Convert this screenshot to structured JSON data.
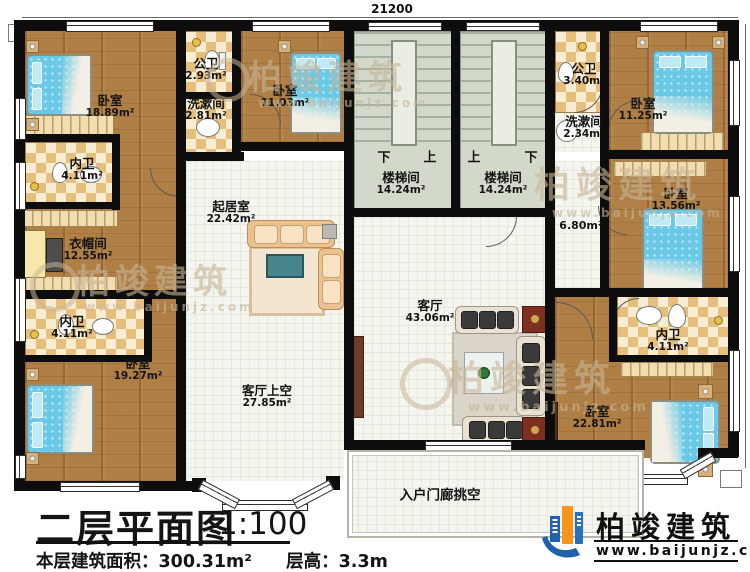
{
  "dimensions": {
    "top": "21200",
    "right": "13800"
  },
  "rooms": {
    "bedroom_tl": {
      "name": "卧室",
      "area": "18.89m²"
    },
    "gongwei_left": {
      "name": "公卫",
      "area": "2.93m²"
    },
    "xishujian_left": {
      "name": "洗漱间",
      "area": "2.81m²"
    },
    "bedroom_tm": {
      "name": "卧室",
      "area": "11.03m²"
    },
    "neiwei_top": {
      "name": "内卫",
      "area": "4.11m²"
    },
    "cloakroom": {
      "name": "衣帽间",
      "area": "12.55m²"
    },
    "neiwei_bottom": {
      "name": "内卫",
      "area": "4.11m²"
    },
    "bedroom_bl": {
      "name": "卧室",
      "area": "19.27m²"
    },
    "qijushi": {
      "name": "起居室",
      "area": "22.42m²"
    },
    "stair_left": {
      "name": "楼梯间",
      "area": "14.24m²",
      "marks": [
        "下",
        "上"
      ]
    },
    "stair_right": {
      "name": "楼梯间",
      "area": "14.24m²",
      "marks": [
        "上",
        "下"
      ]
    },
    "gongwei_right": {
      "name": "公卫",
      "area": "3.40m²"
    },
    "xishujian_right": {
      "name": "洗漱间",
      "area": "2.34m²"
    },
    "bedroom_tr": {
      "name": "卧室",
      "area": "11.25m²"
    },
    "bedroom_mr": {
      "name": "卧室",
      "area": "13.56m²"
    },
    "hallway": {
      "area": "6.80m²"
    },
    "keting": {
      "name": "客厅",
      "area": "43.06m²"
    },
    "keting_void": {
      "name": "客厅上空",
      "area": "27.85m²"
    },
    "neiwei_right": {
      "name": "内卫",
      "area": "4.11m²"
    },
    "bedroom_br": {
      "name": "卧室",
      "area": "22.81m²"
    },
    "porch_void": {
      "name": "入户门廊挑空"
    }
  },
  "title_block": {
    "title": "二层平面图",
    "scale": "1:100",
    "area_text": "本层建筑面积：300.31m²",
    "height_text": "层高：3.3m"
  },
  "brand": {
    "name": "柏竣建筑",
    "url": "www.baijunjz.com"
  },
  "watermark": {
    "text": "柏竣建筑",
    "url": "www.baijunjz.com"
  }
}
